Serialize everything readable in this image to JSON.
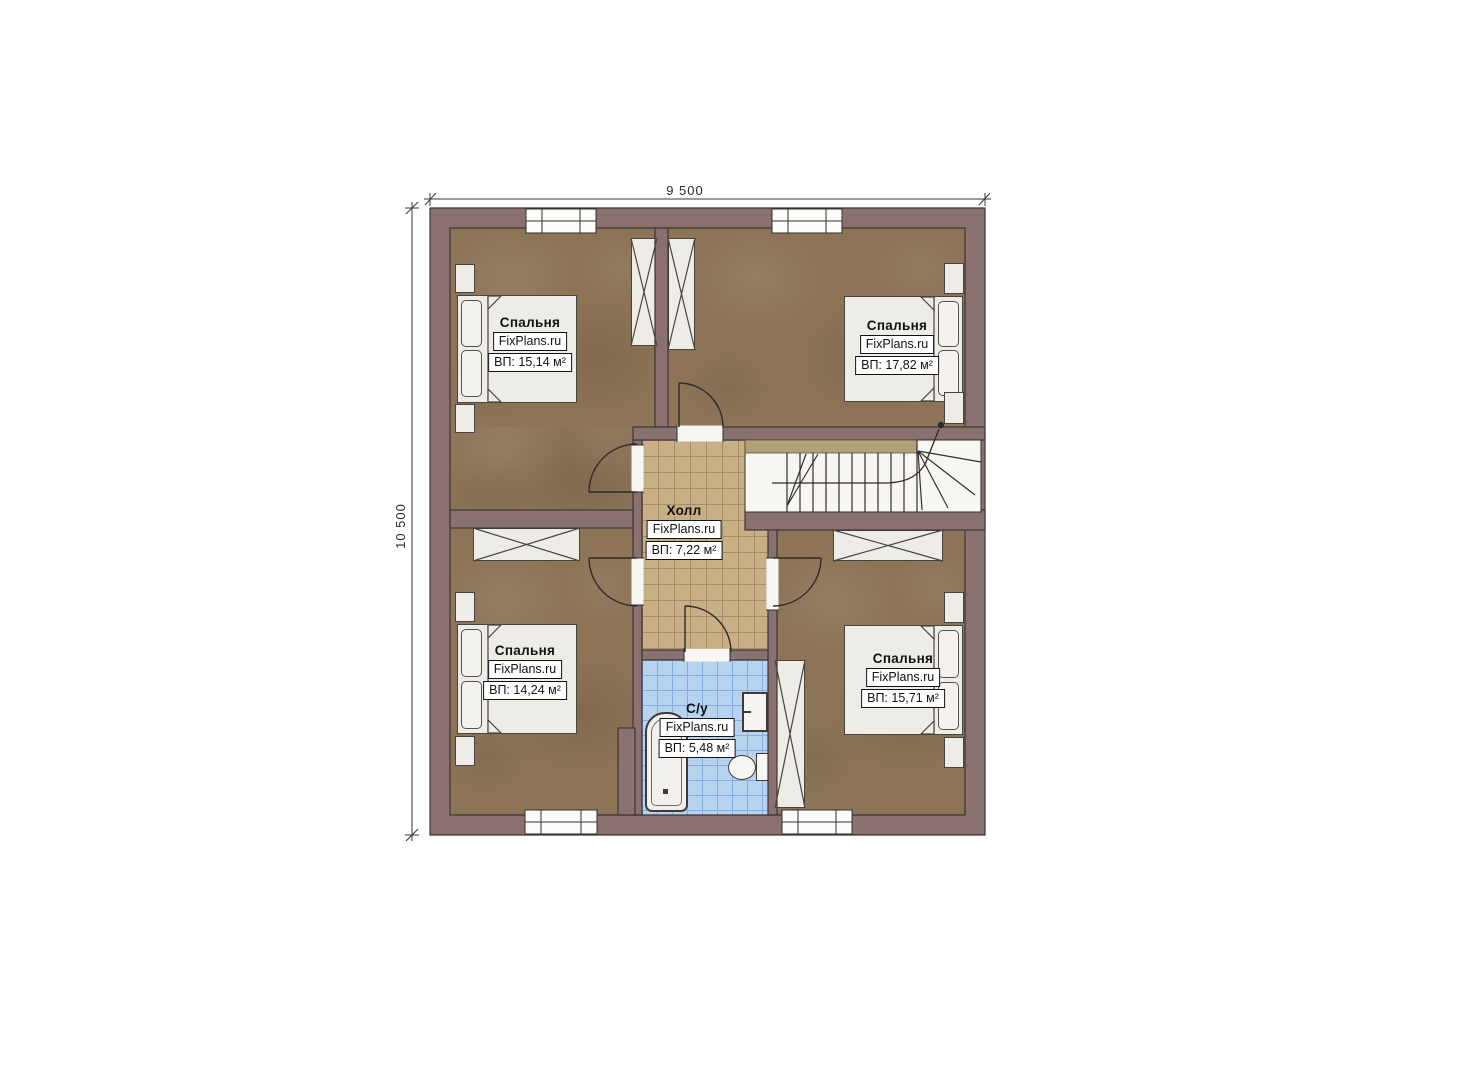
{
  "plan": {
    "dimensions": {
      "width_label": "9 500",
      "height_label": "10 500"
    },
    "branding": "FixPlans.ru",
    "rooms": [
      {
        "id": "bedroom-top-left",
        "name": "Спальня",
        "area": "ВП: 15,14 м²"
      },
      {
        "id": "bedroom-top-right",
        "name": "Спальня",
        "area": "ВП: 17,82 м²"
      },
      {
        "id": "hall",
        "name": "Холл",
        "area": "ВП: 7,22 м²"
      },
      {
        "id": "bedroom-bottom-left",
        "name": "Спальня",
        "area": "ВП: 14,24 м²"
      },
      {
        "id": "bathroom",
        "name": "С/у",
        "area": "ВП: 5,48 м²"
      },
      {
        "id": "bedroom-bottom-right",
        "name": "Спальня",
        "area": "ВП: 15,71 м²"
      }
    ],
    "colors": {
      "wall": "#8a7170",
      "bedroom_floor": "#8d7457",
      "hall_floor": "#c9af85",
      "bathroom_floor": "#b6d3f0",
      "stair_floor": "#f7f6f3",
      "switch_accent": "#df5a1f"
    }
  }
}
